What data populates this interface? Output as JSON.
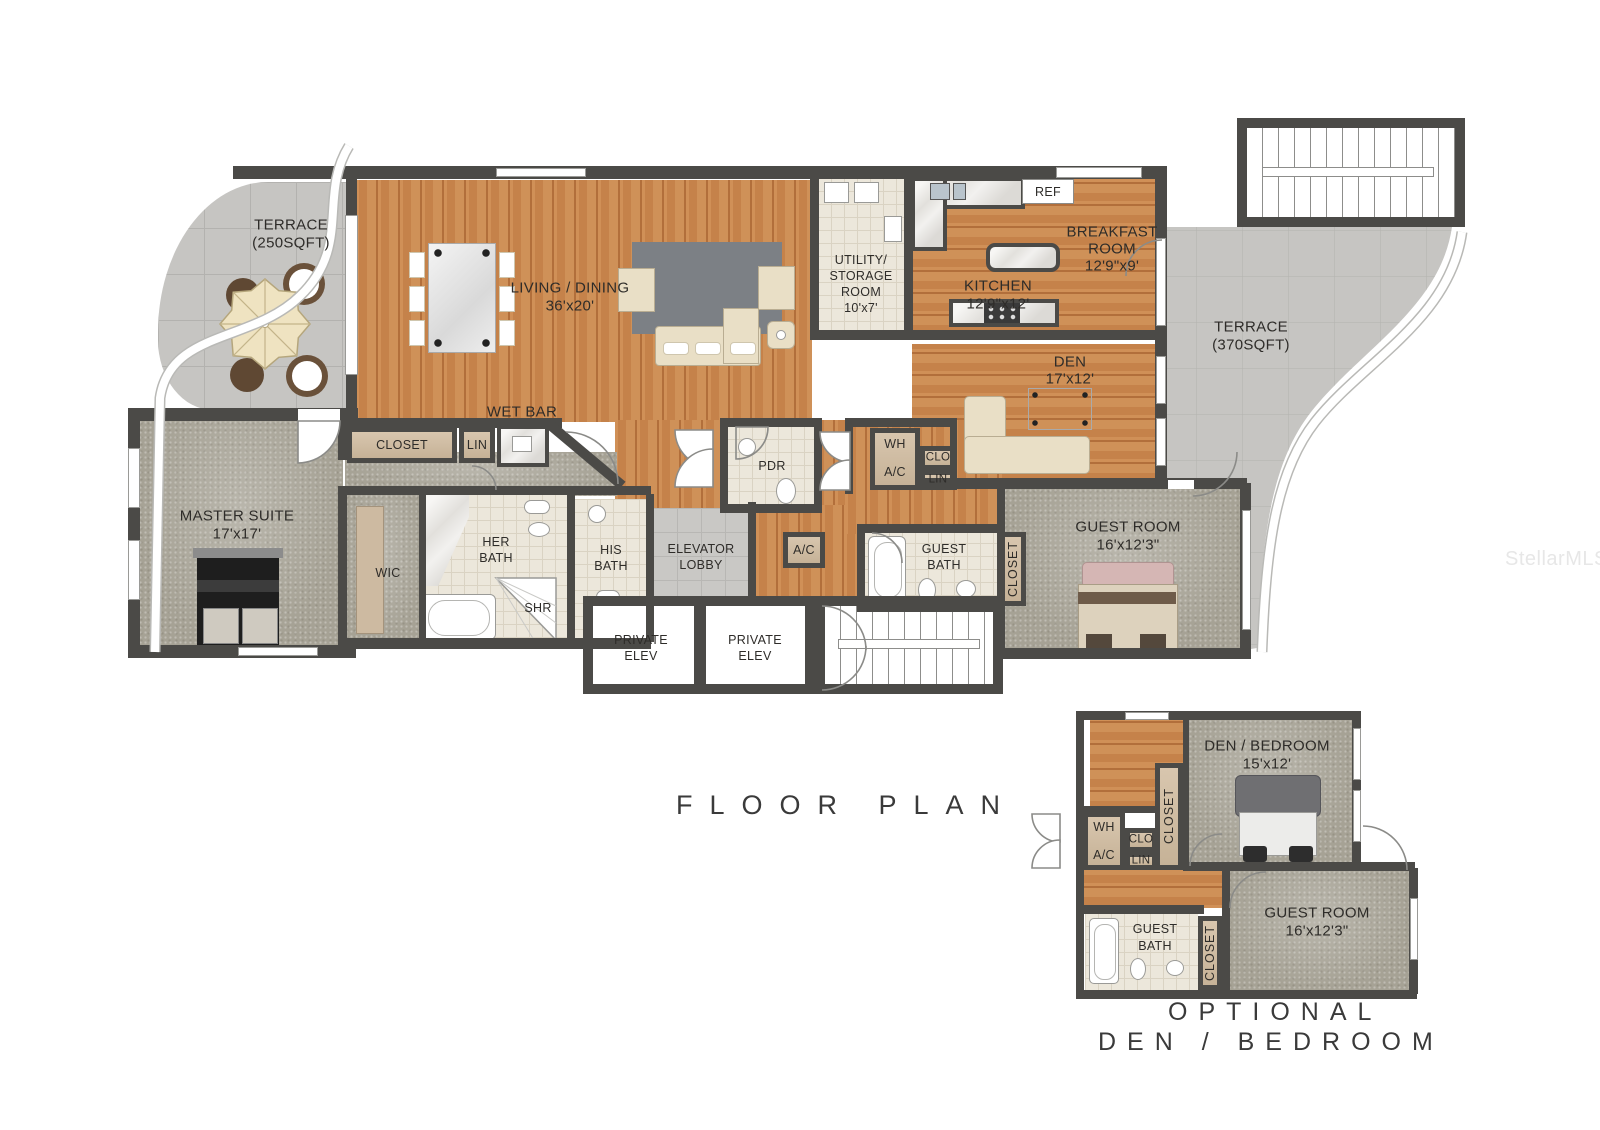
{
  "watermark": "StellarMLS",
  "title": "FLOOR PLAN",
  "optional_title_line1": "OPTIONAL",
  "optional_title_line2": "DEN / BEDROOM",
  "palette": {
    "wall": "#4b4a47",
    "wood_floor": "#c5824a",
    "carpet": "#a6a295",
    "terrace_tile": "#c6c5c2",
    "bath_tile": "#ece7db",
    "closet_tan": "#cdbaa1",
    "label_text": "#2e2c29"
  },
  "rooms": {
    "terrace_left": {
      "name": "TERRACE",
      "size": "(250SQFT)"
    },
    "living_dining": {
      "name": "LIVING / DINING",
      "size": "36'x20'"
    },
    "utility": {
      "name_line1": "UTILITY/",
      "name_line2": "STORAGE",
      "name_line3": "ROOM",
      "size": "10'x7'"
    },
    "kitchen": {
      "name": "KITCHEN",
      "size": "12'9\"x12'"
    },
    "breakfast": {
      "name_line1": "BREAKFAST",
      "name_line2": "ROOM",
      "size": "12'9\"x9'"
    },
    "ref": {
      "label": "REF"
    },
    "den": {
      "name": "DEN",
      "size": "17'x12'"
    },
    "terrace_right": {
      "name": "TERRACE",
      "size": "(370SQFT)"
    },
    "wet_bar": {
      "label": "WET BAR"
    },
    "hall_closet": {
      "label": "CLOSET"
    },
    "hall_lin": {
      "label": "LIN"
    },
    "master_suite": {
      "name": "MASTER SUITE",
      "size": "17'x17'"
    },
    "wic": {
      "label": "WIC"
    },
    "her_bath": {
      "name_line1": "HER",
      "name_line2": "BATH"
    },
    "his_bath": {
      "name_line1": "HIS",
      "name_line2": "BATH"
    },
    "shr": {
      "label": "SHR"
    },
    "elevator_lobby": {
      "name_line1": "ELEVATOR",
      "name_line2": "LOBBY"
    },
    "pdr": {
      "label": "PDR"
    },
    "ac_closet": {
      "label": "A/C"
    },
    "wh": {
      "label": "WH"
    },
    "ac": {
      "label": "A/C"
    },
    "clo": {
      "label": "CLO"
    },
    "lin": {
      "label": "LIN"
    },
    "guest_bath": {
      "name_line1": "GUEST",
      "name_line2": "BATH"
    },
    "guest_closet": {
      "label": "CLOSET"
    },
    "guest_room": {
      "name": "GUEST ROOM",
      "size": "16'x12'3\""
    },
    "private_elev_left": {
      "line1": "PRIVATE",
      "line2": "ELEV"
    },
    "private_elev_right": {
      "line1": "PRIVATE",
      "line2": "ELEV"
    }
  },
  "optional": {
    "den_bedroom": {
      "name": "DEN / BEDROOM",
      "size": "15'x12'"
    },
    "wh": {
      "label": "WH"
    },
    "ac": {
      "label": "A/C"
    },
    "clo": {
      "label": "CLO"
    },
    "lin": {
      "label": "LIN"
    },
    "closet_top": {
      "label": "CLOSET"
    },
    "guest_bath": {
      "name_line1": "GUEST",
      "name_line2": "BATH"
    },
    "closet_bottom": {
      "label": "CLOSET"
    },
    "guest_room": {
      "name": "GUEST ROOM",
      "size": "16'x12'3\""
    }
  }
}
